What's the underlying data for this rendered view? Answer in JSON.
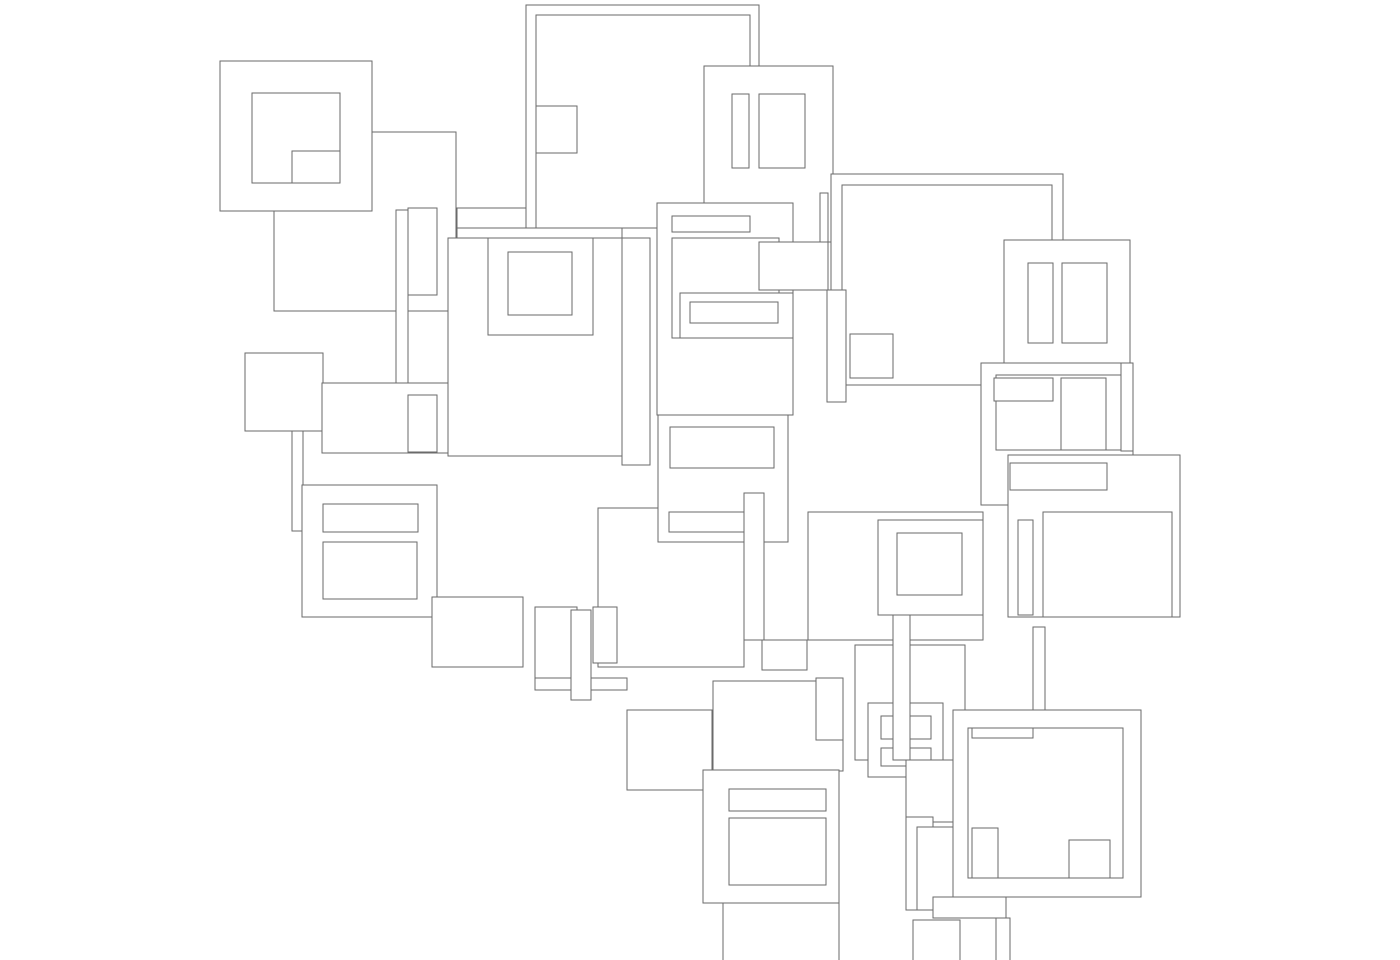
{
  "artwork": {
    "title": "Overlapping rectangles line drawing",
    "description": "Abstract maze-like composition of overlapping white-filled rectangle outlines with thin gray strokes on a white background",
    "canvas": {
      "width": 1400,
      "height": 960,
      "background": "#ffffff"
    },
    "stroke_color": "#6a6a6a",
    "stroke_width": 1.3,
    "fill_color": "#ffffff",
    "rects": [
      [
        274,
        132,
        182,
        179
      ],
      [
        220,
        61,
        152,
        150
      ],
      [
        252,
        93,
        88,
        90
      ],
      [
        292,
        151,
        48,
        32
      ],
      [
        408,
        208,
        29,
        87
      ],
      [
        457,
        208,
        70,
        20
      ],
      [
        396,
        210,
        12,
        183
      ],
      [
        526,
        5,
        233,
        223
      ],
      [
        536,
        15,
        214,
        213
      ],
      [
        536,
        106,
        41,
        47
      ],
      [
        704,
        66,
        129,
        176
      ],
      [
        732,
        94,
        17,
        74
      ],
      [
        759,
        94,
        46,
        74
      ],
      [
        831,
        174,
        232,
        211
      ],
      [
        842,
        185,
        210,
        200
      ],
      [
        1004,
        240,
        126,
        126
      ],
      [
        1028,
        263,
        25,
        80
      ],
      [
        1062,
        263,
        45,
        80
      ],
      [
        820,
        193,
        8,
        97
      ],
      [
        457,
        228,
        165,
        228
      ],
      [
        448,
        238,
        174,
        218
      ],
      [
        488,
        238,
        105,
        97
      ],
      [
        508,
        252,
        64,
        63
      ],
      [
        622,
        238,
        28,
        227
      ],
      [
        245,
        353,
        78,
        78
      ],
      [
        292,
        431,
        11,
        100
      ],
      [
        322,
        383,
        126,
        70
      ],
      [
        302,
        485,
        135,
        132
      ],
      [
        323,
        504,
        95,
        28
      ],
      [
        323,
        542,
        94,
        57
      ],
      [
        408,
        395,
        29,
        57
      ],
      [
        657,
        203,
        136,
        212
      ],
      [
        672,
        216,
        78,
        16
      ],
      [
        672,
        238,
        107,
        100
      ],
      [
        759,
        242,
        69,
        48
      ],
      [
        680,
        293,
        113,
        45
      ],
      [
        690,
        302,
        88,
        21
      ],
      [
        827,
        290,
        19,
        112
      ],
      [
        850,
        334,
        43,
        44
      ],
      [
        598,
        508,
        146,
        159
      ],
      [
        658,
        415,
        130,
        127
      ],
      [
        670,
        427,
        104,
        41
      ],
      [
        669,
        512,
        77,
        20
      ],
      [
        744,
        493,
        20,
        147
      ],
      [
        981,
        363,
        152,
        142
      ],
      [
        996,
        375,
        125,
        75
      ],
      [
        994,
        378,
        59,
        23
      ],
      [
        1061,
        378,
        45,
        72
      ],
      [
        1121,
        363,
        12,
        88
      ],
      [
        1008,
        455,
        172,
        162
      ],
      [
        1043,
        512,
        129,
        105
      ],
      [
        1010,
        463,
        97,
        27
      ],
      [
        1018,
        520,
        15,
        95
      ],
      [
        1033,
        627,
        12,
        83
      ],
      [
        808,
        512,
        175,
        128
      ],
      [
        878,
        520,
        105,
        95
      ],
      [
        897,
        533,
        65,
        62
      ],
      [
        432,
        597,
        91,
        70
      ],
      [
        535,
        607,
        42,
        83
      ],
      [
        593,
        607,
        24,
        56
      ],
      [
        535,
        678,
        92,
        12
      ],
      [
        571,
        610,
        20,
        90
      ],
      [
        627,
        710,
        85,
        80
      ],
      [
        713,
        681,
        130,
        90
      ],
      [
        816,
        678,
        27,
        62
      ],
      [
        762,
        640,
        45,
        30
      ],
      [
        703,
        770,
        136,
        133
      ],
      [
        729,
        789,
        97,
        22
      ],
      [
        729,
        818,
        97,
        67
      ],
      [
        723,
        903,
        116,
        70
      ],
      [
        855,
        645,
        110,
        115
      ],
      [
        868,
        703,
        75,
        74
      ],
      [
        881,
        716,
        50,
        23
      ],
      [
        881,
        748,
        50,
        18
      ],
      [
        906,
        760,
        59,
        62
      ],
      [
        906,
        817,
        27,
        93
      ],
      [
        917,
        827,
        38,
        83
      ],
      [
        913,
        920,
        47,
        55
      ],
      [
        893,
        615,
        17,
        145
      ],
      [
        953,
        710,
        188,
        187
      ],
      [
        968,
        728,
        155,
        150
      ],
      [
        972,
        728,
        61,
        10
      ],
      [
        972,
        828,
        26,
        50
      ],
      [
        1069,
        840,
        41,
        38
      ],
      [
        933,
        897,
        73,
        21
      ],
      [
        996,
        918,
        14,
        50
      ]
    ]
  }
}
